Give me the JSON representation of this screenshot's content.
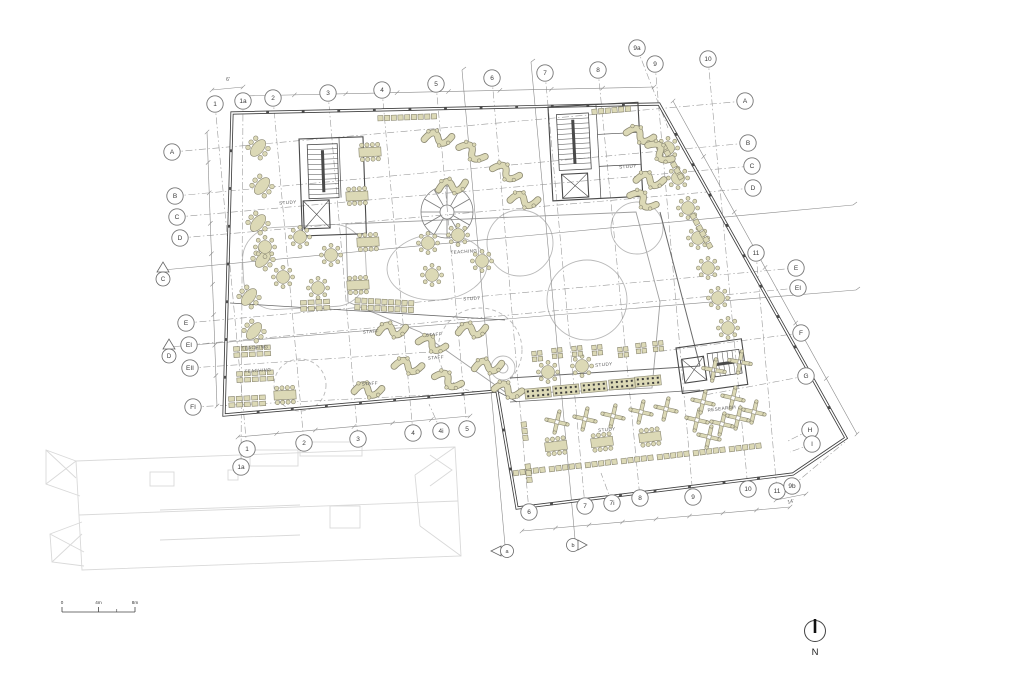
{
  "title": "architectural-floor-plan",
  "colors": {
    "background": "#ffffff",
    "wall": "#3f3f3f",
    "interior_wall": "#6a6a6a",
    "grid_line": "#9a9a9a",
    "section_line": "#8a8a8a",
    "furniture_fill": "#dcd9b6",
    "furniture_stroke": "#8b8872",
    "ghost_building": "#d9d9d9",
    "light_curve": "#b9b9b9",
    "annotation": "#555555",
    "bubble_stroke": "#777777"
  },
  "plan": {
    "grid_bubbles": [
      {
        "label": "1",
        "x": 215,
        "y": 104,
        "tx": 247,
        "ty": 449
      },
      {
        "label": "1a",
        "x": 243,
        "y": 101,
        "tx": 241,
        "ty": 467
      },
      {
        "label": "2",
        "x": 273,
        "y": 98,
        "tx": 304,
        "ty": 443
      },
      {
        "label": "3",
        "x": 328,
        "y": 93,
        "tx": 358,
        "ty": 439
      },
      {
        "label": "4",
        "x": 382,
        "y": 90,
        "tx": 413,
        "ty": 433
      },
      {
        "label": "5",
        "x": 436,
        "y": 84,
        "tx": 467,
        "ty": 429
      },
      {
        "label": "6",
        "x": 492,
        "y": 78,
        "tx": 529,
        "ty": 512
      },
      {
        "label": "7",
        "x": 545,
        "y": 73,
        "tx": 585,
        "ty": 506
      },
      {
        "label": "8",
        "x": 598,
        "y": 70,
        "tx": 640,
        "ty": 498
      },
      {
        "label": "9a",
        "x": 637,
        "y": 48,
        "tx": 668,
        "ty": 128
      },
      {
        "label": "9",
        "x": 655,
        "y": 64,
        "tx": 693,
        "ty": 497
      },
      {
        "label": "10",
        "x": 708,
        "y": 59,
        "tx": 748,
        "ty": 489
      },
      {
        "label": "A",
        "x": 172,
        "y": 152,
        "tx": 745,
        "ty": 101
      },
      {
        "label": "B",
        "x": 175,
        "y": 196,
        "tx": 748,
        "ty": 143
      },
      {
        "label": "C",
        "x": 177,
        "y": 217,
        "tx": 752,
        "ty": 166
      },
      {
        "label": "D",
        "x": 180,
        "y": 238,
        "tx": 753,
        "ty": 188
      },
      {
        "label": "E",
        "x": 186,
        "y": 323,
        "tx": 796,
        "ty": 268
      },
      {
        "label": "EI",
        "x": 189,
        "y": 345,
        "tx": 798,
        "ty": 288
      },
      {
        "label": "EII",
        "x": 190,
        "y": 368,
        "tx": 430,
        "ty": 352
      },
      {
        "label": "FI",
        "x": 193,
        "y": 407,
        "tx": 490,
        "ty": 392
      },
      {
        "label": "A",
        "x": 745,
        "y": 101
      },
      {
        "label": "B",
        "x": 748,
        "y": 143
      },
      {
        "label": "C",
        "x": 752,
        "y": 166
      },
      {
        "label": "D",
        "x": 753,
        "y": 188
      },
      {
        "label": "11",
        "x": 756,
        "y": 253,
        "tx": 777,
        "ty": 491
      },
      {
        "label": "E",
        "x": 796,
        "y": 268
      },
      {
        "label": "EI",
        "x": 798,
        "y": 288
      },
      {
        "label": "F",
        "x": 801,
        "y": 333,
        "tx": 655,
        "ty": 352
      },
      {
        "label": "G",
        "x": 806,
        "y": 376,
        "tx": 705,
        "ty": 395
      },
      {
        "label": "H",
        "x": 810,
        "y": 430,
        "tx": 788,
        "ty": 441
      },
      {
        "label": "I",
        "x": 812,
        "y": 444,
        "tx": 790,
        "ty": 452
      },
      {
        "label": "1",
        "x": 247,
        "y": 449
      },
      {
        "label": "1a",
        "x": 241,
        "y": 467
      },
      {
        "label": "2",
        "x": 304,
        "y": 443
      },
      {
        "label": "3",
        "x": 358,
        "y": 439
      },
      {
        "label": "4",
        "x": 413,
        "y": 433
      },
      {
        "label": "4i",
        "x": 441,
        "y": 431,
        "tx": 429,
        "ty": 404
      },
      {
        "label": "5",
        "x": 467,
        "y": 429
      },
      {
        "label": "6",
        "x": 529,
        "y": 512
      },
      {
        "label": "7",
        "x": 585,
        "y": 506
      },
      {
        "label": "7i",
        "x": 612,
        "y": 503,
        "tx": 601,
        "ty": 473
      },
      {
        "label": "8",
        "x": 640,
        "y": 498
      },
      {
        "label": "9",
        "x": 693,
        "y": 497
      },
      {
        "label": "10",
        "x": 748,
        "y": 489
      },
      {
        "label": "11",
        "x": 777,
        "y": 491
      },
      {
        "label": "9b",
        "x": 792,
        "y": 486,
        "tx": 845,
        "ty": 442
      }
    ],
    "section_markers": [
      {
        "label": "C",
        "x": 163,
        "y": 276,
        "lx": 853,
        "ly": 205,
        "shape": "tri-circle"
      },
      {
        "label": "D",
        "x": 169,
        "y": 353,
        "lx": 856,
        "ly": 290,
        "shape": "tri-circle"
      },
      {
        "label": "a",
        "x": 505,
        "y": 551,
        "lx": 462,
        "ly": 70,
        "shape": "flag-left"
      },
      {
        "label": "b",
        "x": 575,
        "y": 545,
        "lx": 531,
        "ly": 62,
        "shape": "flag-right"
      }
    ],
    "room_labels": [
      {
        "text": "STUDY",
        "x": 288,
        "y": 204,
        "a": -4
      },
      {
        "text": "STUDY",
        "x": 628,
        "y": 168,
        "a": -4
      },
      {
        "text": "STUDY",
        "x": 472,
        "y": 300,
        "a": -3
      },
      {
        "text": "STUDY",
        "x": 604,
        "y": 366,
        "a": -5
      },
      {
        "text": "STUDY",
        "x": 607,
        "y": 431,
        "a": -6
      },
      {
        "text": "TEACHING",
        "x": 255,
        "y": 349,
        "a": -4
      },
      {
        "text": "TEACHING",
        "x": 258,
        "y": 372,
        "a": -4
      },
      {
        "text": "TEACHING",
        "x": 464,
        "y": 253,
        "a": -4
      },
      {
        "text": "STAFF",
        "x": 371,
        "y": 333,
        "a": -4
      },
      {
        "text": "STAFF",
        "x": 434,
        "y": 336,
        "a": -4
      },
      {
        "text": "STAFF",
        "x": 436,
        "y": 359,
        "a": -4
      },
      {
        "text": "STAFF",
        "x": 370,
        "y": 385,
        "a": -4
      },
      {
        "text": "RESEARCH",
        "x": 722,
        "y": 410,
        "a": -7
      }
    ],
    "dim_labels": [
      {
        "text": "6'",
        "x": 228,
        "y": 81,
        "a": 0
      },
      {
        "text": "14'",
        "x": 791,
        "y": 503,
        "a": -14
      }
    ],
    "scale_bar": {
      "labels": [
        "0",
        "4m",
        "8m"
      ],
      "x": 62,
      "y": 604,
      "width": 73
    },
    "north": {
      "label": "N",
      "x": 815,
      "y": 631
    }
  },
  "furniture": [
    {
      "t": "oval6",
      "x": 258,
      "y": 148,
      "a": -50
    },
    {
      "t": "oval6",
      "x": 262,
      "y": 186,
      "a": -50
    },
    {
      "t": "oval6",
      "x": 258,
      "y": 223,
      "a": -50
    },
    {
      "t": "oval6",
      "x": 263,
      "y": 259,
      "a": -50
    },
    {
      "t": "oval6",
      "x": 249,
      "y": 297,
      "a": -50
    },
    {
      "t": "oval6",
      "x": 254,
      "y": 331,
      "a": -50
    },
    {
      "t": "rect8",
      "x": 370,
      "y": 152,
      "a": -3
    },
    {
      "t": "rect8",
      "x": 357,
      "y": 196,
      "a": -3
    },
    {
      "t": "rect8",
      "x": 368,
      "y": 242,
      "a": -3
    },
    {
      "t": "rect8",
      "x": 358,
      "y": 285,
      "a": -3
    },
    {
      "t": "rect8",
      "x": 285,
      "y": 395,
      "a": -3
    },
    {
      "t": "rect8",
      "x": 556,
      "y": 446,
      "a": -7
    },
    {
      "t": "rect8",
      "x": 602,
      "y": 442,
      "a": -7
    },
    {
      "t": "rect8",
      "x": 650,
      "y": 437,
      "a": -7
    },
    {
      "t": "round8",
      "x": 265,
      "y": 247,
      "a": 0
    },
    {
      "t": "round8",
      "x": 300,
      "y": 237,
      "a": 0
    },
    {
      "t": "round8",
      "x": 331,
      "y": 255,
      "a": 0
    },
    {
      "t": "round8",
      "x": 283,
      "y": 277,
      "a": 0
    },
    {
      "t": "round8",
      "x": 318,
      "y": 288,
      "a": 0
    },
    {
      "t": "round8",
      "x": 428,
      "y": 243,
      "a": 0
    },
    {
      "t": "round8",
      "x": 458,
      "y": 235,
      "a": 0
    },
    {
      "t": "round8",
      "x": 482,
      "y": 261,
      "a": 0
    },
    {
      "t": "round8",
      "x": 432,
      "y": 275,
      "a": 0
    },
    {
      "t": "round8",
      "x": 668,
      "y": 148,
      "a": 0
    },
    {
      "t": "round8",
      "x": 678,
      "y": 178,
      "a": 0
    },
    {
      "t": "round8",
      "x": 688,
      "y": 208,
      "a": 0
    },
    {
      "t": "round8",
      "x": 698,
      "y": 238,
      "a": 0
    },
    {
      "t": "round8",
      "x": 708,
      "y": 268,
      "a": 0
    },
    {
      "t": "round8",
      "x": 718,
      "y": 298,
      "a": 0
    },
    {
      "t": "round8",
      "x": 728,
      "y": 328,
      "a": 0
    },
    {
      "t": "round8",
      "x": 548,
      "y": 372,
      "a": 0
    },
    {
      "t": "round8",
      "x": 582,
      "y": 366,
      "a": 0
    },
    {
      "t": "grid",
      "x": 316,
      "y": 306,
      "a": -3,
      "rows": 2,
      "cols": 4
    },
    {
      "t": "grid",
      "x": 253,
      "y": 352,
      "a": -3,
      "rows": 2,
      "cols": 5
    },
    {
      "t": "grid",
      "x": 256,
      "y": 377,
      "a": -3,
      "rows": 2,
      "cols": 5
    },
    {
      "t": "grid",
      "x": 248,
      "y": 402,
      "a": -3,
      "rows": 2,
      "cols": 5
    },
    {
      "t": "row",
      "x": 408,
      "y": 118,
      "a": -2,
      "n": 9,
      "rows": 1
    },
    {
      "t": "row",
      "x": 612,
      "y": 111,
      "a": -5,
      "n": 6,
      "rows": 1
    },
    {
      "t": "row",
      "x": 672,
      "y": 163,
      "a": 61,
      "n": 6,
      "rows": 1
    },
    {
      "t": "row",
      "x": 701,
      "y": 232,
      "a": 61,
      "n": 6,
      "rows": 1
    },
    {
      "t": "row",
      "x": 385,
      "y": 306,
      "a": 3,
      "n": 9,
      "rows": 2
    },
    {
      "t": "row",
      "x": 530,
      "y": 472,
      "a": -7,
      "n": 5,
      "rows": 1
    },
    {
      "t": "row",
      "x": 566,
      "y": 468,
      "a": -7,
      "n": 5,
      "rows": 1
    },
    {
      "t": "row",
      "x": 602,
      "y": 464,
      "a": -7,
      "n": 5,
      "rows": 1
    },
    {
      "t": "row",
      "x": 638,
      "y": 460,
      "a": -7,
      "n": 5,
      "rows": 1
    },
    {
      "t": "row",
      "x": 674,
      "y": 456,
      "a": -7,
      "n": 5,
      "rows": 1
    },
    {
      "t": "row",
      "x": 710,
      "y": 452,
      "a": -7,
      "n": 5,
      "rows": 1
    },
    {
      "t": "row",
      "x": 746,
      "y": 448,
      "a": -7,
      "n": 5,
      "rows": 1
    },
    {
      "t": "row",
      "x": 524,
      "y": 432,
      "a": 83,
      "n": 3,
      "rows": 1
    },
    {
      "t": "row",
      "x": 528,
      "y": 474,
      "a": 83,
      "n": 3,
      "rows": 1
    },
    {
      "t": "pair4",
      "x": 537,
      "y": 356,
      "a": -6
    },
    {
      "t": "pair4",
      "x": 557,
      "y": 353,
      "a": -6
    },
    {
      "t": "pair4",
      "x": 577,
      "y": 351,
      "a": -6
    },
    {
      "t": "pair4",
      "x": 597,
      "y": 350,
      "a": -6
    },
    {
      "t": "pair4",
      "x": 623,
      "y": 352,
      "a": -6
    },
    {
      "t": "pair4",
      "x": 641,
      "y": 348,
      "a": -6
    },
    {
      "t": "pair4",
      "x": 658,
      "y": 346,
      "a": -6
    },
    {
      "t": "scurve",
      "x": 438,
      "y": 138,
      "a": 15
    },
    {
      "t": "scurve",
      "x": 472,
      "y": 152,
      "a": 40
    },
    {
      "t": "scurve",
      "x": 452,
      "y": 186,
      "a": 5
    },
    {
      "t": "scurve",
      "x": 506,
      "y": 172,
      "a": 35
    },
    {
      "t": "scurve",
      "x": 524,
      "y": 200,
      "a": 20
    },
    {
      "t": "scurve",
      "x": 640,
      "y": 135,
      "a": 30
    },
    {
      "t": "scurve",
      "x": 660,
      "y": 152,
      "a": 50
    },
    {
      "t": "scurve",
      "x": 650,
      "y": 180,
      "a": 20
    },
    {
      "t": "scurve",
      "x": 643,
      "y": 200,
      "a": 40
    },
    {
      "t": "scurve",
      "x": 392,
      "y": 330,
      "a": 10
    },
    {
      "t": "scurve",
      "x": 432,
      "y": 344,
      "a": 30
    },
    {
      "t": "scurve",
      "x": 472,
      "y": 330,
      "a": 10
    },
    {
      "t": "scurve",
      "x": 408,
      "y": 366,
      "a": 20
    },
    {
      "t": "scurve",
      "x": 448,
      "y": 380,
      "a": 35
    },
    {
      "t": "scurve",
      "x": 488,
      "y": 366,
      "a": 10
    },
    {
      "t": "scurve",
      "x": 508,
      "y": 390,
      "a": 25
    },
    {
      "t": "scurve",
      "x": 368,
      "y": 390,
      "a": 15
    },
    {
      "t": "xcluster",
      "x": 557,
      "y": 422,
      "a": -7
    },
    {
      "t": "xcluster",
      "x": 585,
      "y": 419,
      "a": -7
    },
    {
      "t": "xcluster",
      "x": 613,
      "y": 416,
      "a": -7
    },
    {
      "t": "xcluster",
      "x": 641,
      "y": 412,
      "a": -7
    },
    {
      "t": "xcluster",
      "x": 666,
      "y": 409,
      "a": -7
    },
    {
      "t": "xcluster",
      "x": 697,
      "y": 420,
      "a": -7
    },
    {
      "t": "xcluster",
      "x": 709,
      "y": 437,
      "a": -7
    },
    {
      "t": "xcluster",
      "x": 722,
      "y": 424,
      "a": -7
    },
    {
      "t": "xcluster",
      "x": 738,
      "y": 418,
      "a": -7
    },
    {
      "t": "xcluster",
      "x": 754,
      "y": 412,
      "a": -7
    },
    {
      "t": "xcluster",
      "x": 703,
      "y": 402,
      "a": -7
    },
    {
      "t": "xcluster",
      "x": 733,
      "y": 398,
      "a": -7
    },
    {
      "t": "xcluster",
      "x": 740,
      "y": 362,
      "a": -10
    },
    {
      "t": "xcluster",
      "x": 714,
      "y": 370,
      "a": -10
    },
    {
      "t": "bench",
      "x": 538,
      "y": 393,
      "a": -5
    },
    {
      "t": "bench",
      "x": 566,
      "y": 390,
      "a": -5
    },
    {
      "t": "bench",
      "x": 594,
      "y": 387,
      "a": -5
    },
    {
      "t": "bench",
      "x": 622,
      "y": 384,
      "a": -5
    },
    {
      "t": "bench",
      "x": 648,
      "y": 381,
      "a": -5
    }
  ]
}
